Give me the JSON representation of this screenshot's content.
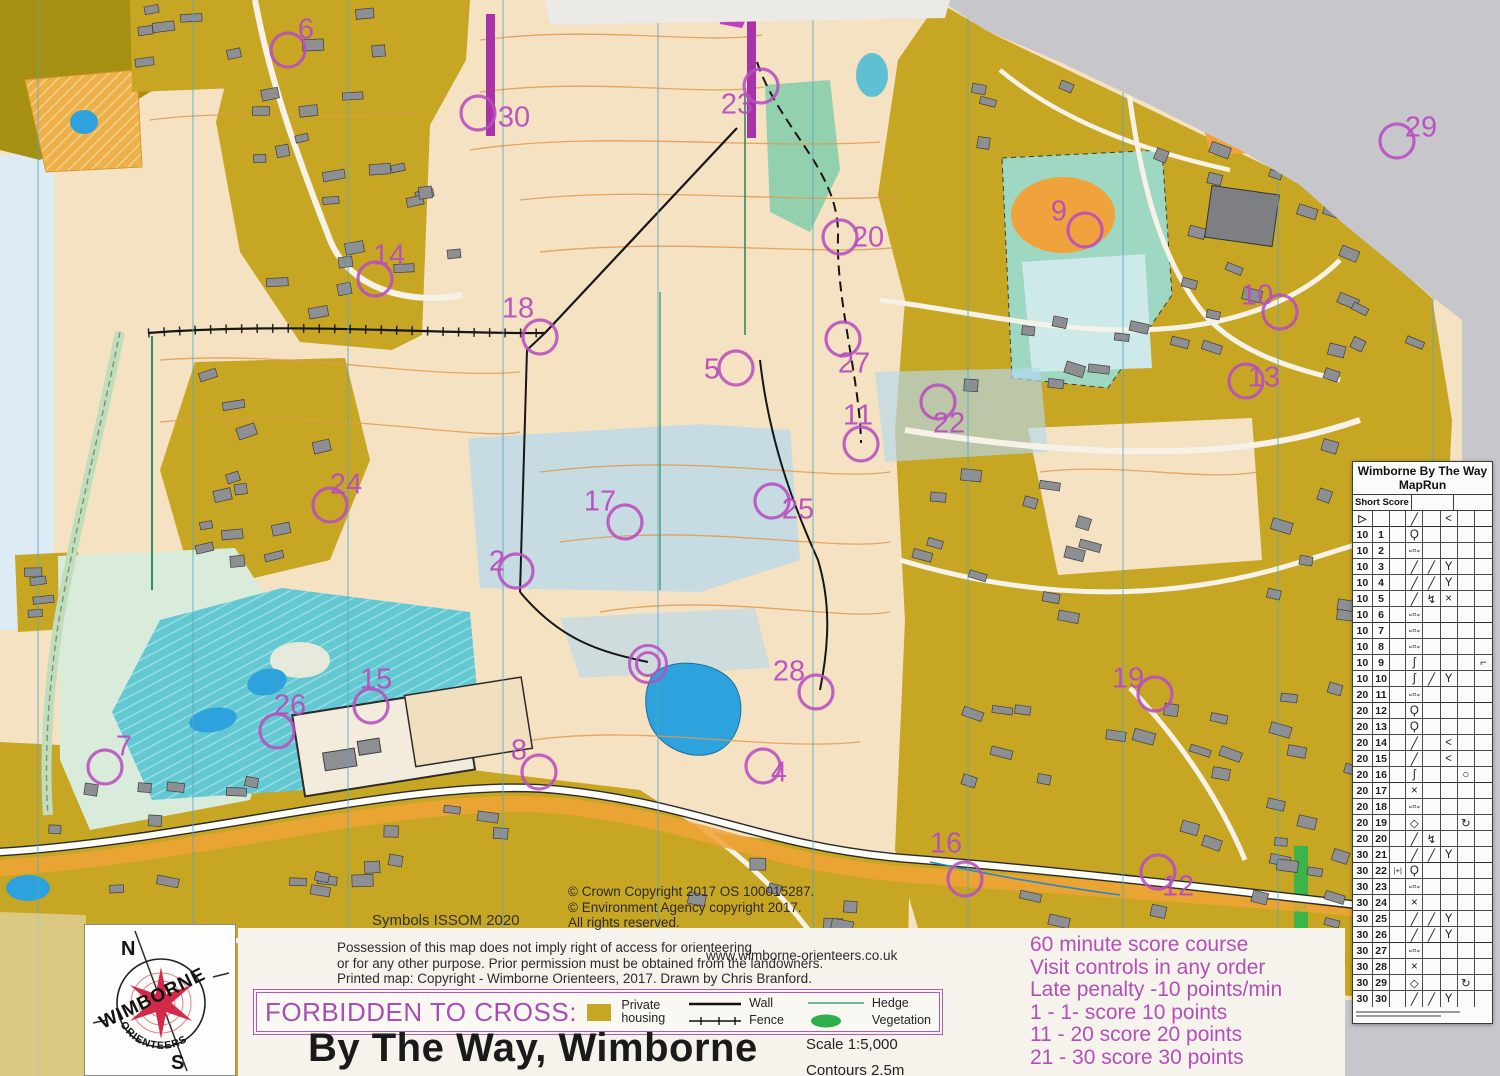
{
  "map_title": "By The Way, Wimborne",
  "forbidden_label": "FORBIDDEN TO CROSS:",
  "scale_label": "Scale 1:5,000",
  "contours_label": "Contours 2.5m",
  "symbols_note": "Symbols ISSOM 2020",
  "website": "www.wimborne-orienteers.co.uk",
  "copyright": {
    "lines": [
      "© Crown Copyright 2017 OS 100015287.",
      "© Environment Agency copyright 2017.",
      "All rights reserved."
    ]
  },
  "disclaimer": {
    "lines": [
      "Possession of this map does not imply right of access for orienteering",
      "or for any other purpose.  Prior permission must be obtained from the landowners.",
      "Printed map: Copyright - Wimborne Orienteers, 2017. Drawn by Chris Branford."
    ]
  },
  "score_rules": {
    "lines": [
      "60 minute score course",
      "Visit controls in any order",
      "Late penalty -10 points/min",
      "1 - 1- score 10 points",
      "11 - 20 score 20 points",
      "21 - 30 score 30 points"
    ]
  },
  "legend": {
    "private_line1": "Private",
    "private_line2": "housing",
    "wall": "Wall",
    "fence": "Fence",
    "hedge": "Hedge",
    "vegetation": "Vegetation"
  },
  "logo": {
    "word_main": "WIMBORNE",
    "word_sub": "ORIENTEERS",
    "north": "N",
    "south": "S"
  },
  "colors": {
    "course": "#b84fbe",
    "housing": "#c7a623",
    "open": "#f4e2c2",
    "water": "#2da2dc",
    "lake": "#63c8d2",
    "paper": "#c7c7cb"
  },
  "control_sheet": {
    "title_line1": "Wimborne By The Way",
    "title_line2": "MapRun",
    "subheader": "Short Score",
    "rows": [
      {
        "a": "▷",
        "b": "",
        "c": "",
        "d": "╱",
        "e": "",
        "f": "<",
        "g": "",
        "h": ""
      },
      {
        "a": "10",
        "b": "1",
        "c": "",
        "d": "Ϙ",
        "e": "",
        "f": "",
        "g": "",
        "h": ""
      },
      {
        "a": "10",
        "b": "2",
        "c": "",
        "d": "-▫-",
        "e": "",
        "f": "",
        "g": "",
        "h": ""
      },
      {
        "a": "10",
        "b": "3",
        "c": "",
        "d": "╱",
        "e": "╱",
        "f": "Y",
        "g": "",
        "h": ""
      },
      {
        "a": "10",
        "b": "4",
        "c": "",
        "d": "╱",
        "e": "╱",
        "f": "Y",
        "g": "",
        "h": ""
      },
      {
        "a": "10",
        "b": "5",
        "c": "",
        "d": "╱",
        "e": "↯",
        "f": "×",
        "g": "",
        "h": ""
      },
      {
        "a": "10",
        "b": "6",
        "c": "",
        "d": "-▫-",
        "e": "",
        "f": "",
        "g": "",
        "h": ""
      },
      {
        "a": "10",
        "b": "7",
        "c": "",
        "d": "-▫-",
        "e": "",
        "f": "",
        "g": "",
        "h": ""
      },
      {
        "a": "10",
        "b": "8",
        "c": "",
        "d": "-▫-",
        "e": "",
        "f": "",
        "g": "",
        "h": ""
      },
      {
        "a": "10",
        "b": "9",
        "c": "",
        "d": "ʃ",
        "e": "",
        "f": "",
        "g": "",
        "h": "⌐"
      },
      {
        "a": "10",
        "b": "10",
        "c": "",
        "d": "ʃ",
        "e": "╱",
        "f": "Y",
        "g": "",
        "h": ""
      },
      {
        "a": "20",
        "b": "11",
        "c": "",
        "d": "-▫-",
        "e": "",
        "f": "",
        "g": "",
        "h": ""
      },
      {
        "a": "20",
        "b": "12",
        "c": "",
        "d": "Ϙ",
        "e": "",
        "f": "",
        "g": "",
        "h": ""
      },
      {
        "a": "20",
        "b": "13",
        "c": "",
        "d": "Ϙ",
        "e": "",
        "f": "",
        "g": "",
        "h": ""
      },
      {
        "a": "20",
        "b": "14",
        "c": "",
        "d": "╱",
        "e": "",
        "f": "<",
        "g": "",
        "h": ""
      },
      {
        "a": "20",
        "b": "15",
        "c": "",
        "d": "╱",
        "e": "",
        "f": "<",
        "g": "",
        "h": ""
      },
      {
        "a": "20",
        "b": "16",
        "c": "",
        "d": "ʃ",
        "e": "",
        "f": "",
        "g": "○",
        "h": ""
      },
      {
        "a": "20",
        "b": "17",
        "c": "",
        "d": "×",
        "e": "",
        "f": "",
        "g": "",
        "h": ""
      },
      {
        "a": "20",
        "b": "18",
        "c": "",
        "d": "-▫-",
        "e": "",
        "f": "",
        "g": "",
        "h": ""
      },
      {
        "a": "20",
        "b": "19",
        "c": "",
        "d": "◇",
        "e": "",
        "f": "",
        "g": "↻",
        "h": ""
      },
      {
        "a": "20",
        "b": "20",
        "c": "",
        "d": "╱",
        "e": "↯",
        "f": "",
        "g": "",
        "h": ""
      },
      {
        "a": "30",
        "b": "21",
        "c": "",
        "d": "╱",
        "e": "╱",
        "f": "Y",
        "g": "",
        "h": ""
      },
      {
        "a": "30",
        "b": "22",
        "c": "|+|",
        "d": "Ϙ",
        "e": "",
        "f": "",
        "g": "",
        "h": ""
      },
      {
        "a": "30",
        "b": "23",
        "c": "",
        "d": "-▫-",
        "e": "",
        "f": "",
        "g": "",
        "h": ""
      },
      {
        "a": "30",
        "b": "24",
        "c": "",
        "d": "×",
        "e": "",
        "f": "",
        "g": "",
        "h": ""
      },
      {
        "a": "30",
        "b": "25",
        "c": "",
        "d": "╱",
        "e": "╱",
        "f": "Y",
        "g": "",
        "h": ""
      },
      {
        "a": "30",
        "b": "26",
        "c": "",
        "d": "╱",
        "e": "╱",
        "f": "Y",
        "g": "",
        "h": ""
      },
      {
        "a": "30",
        "b": "27",
        "c": "",
        "d": "-▫-",
        "e": "",
        "f": "",
        "g": "",
        "h": ""
      },
      {
        "a": "30",
        "b": "28",
        "c": "",
        "d": "×",
        "e": "",
        "f": "",
        "g": "",
        "h": ""
      },
      {
        "a": "30",
        "b": "29",
        "c": "",
        "d": "◇",
        "e": "",
        "f": "",
        "g": "↻",
        "h": ""
      },
      {
        "a": "30",
        "b": "30",
        "c": "",
        "d": "╱",
        "e": "╱",
        "f": "Y",
        "g": "",
        "h": ""
      }
    ]
  },
  "course": {
    "start_finish": {
      "cx": 648,
      "cy": 664
    },
    "controls": [
      {
        "n": "6",
        "lx": 306,
        "ly": 31,
        "cx": 288,
        "cy": 50
      },
      {
        "n": "30",
        "lx": 514,
        "ly": 119,
        "cx": 478,
        "cy": 113
      },
      {
        "n": "23",
        "lx": 737,
        "ly": 106,
        "cx": 761,
        "cy": 86
      },
      {
        "n": "20",
        "lx": 868,
        "ly": 239,
        "cx": 840,
        "cy": 237
      },
      {
        "n": "14",
        "lx": 389,
        "ly": 257,
        "cx": 375,
        "cy": 279
      },
      {
        "n": "18",
        "lx": 518,
        "ly": 310,
        "cx": 540,
        "cy": 337
      },
      {
        "n": "5",
        "lx": 712,
        "ly": 371,
        "cx": 736,
        "cy": 368
      },
      {
        "n": "27",
        "lx": 854,
        "ly": 365,
        "cx": 843,
        "cy": 339
      },
      {
        "n": "29",
        "lx": 1421,
        "ly": 129,
        "cx": 1397,
        "cy": 141
      },
      {
        "n": "9",
        "lx": 1059,
        "ly": 213,
        "cx": 1085,
        "cy": 230
      },
      {
        "n": "10",
        "lx": 1257,
        "ly": 297,
        "cx": 1280,
        "cy": 312
      },
      {
        "n": "13",
        "lx": 1264,
        "ly": 379,
        "cx": 1246,
        "cy": 381
      },
      {
        "n": "11",
        "lx": 858,
        "ly": 417,
        "cx": 861,
        "cy": 444
      },
      {
        "n": "22",
        "lx": 949,
        "ly": 425,
        "cx": 938,
        "cy": 402
      },
      {
        "n": "24",
        "lx": 346,
        "ly": 486,
        "cx": 330,
        "cy": 505
      },
      {
        "n": "17",
        "lx": 600,
        "ly": 503,
        "cx": 625,
        "cy": 522
      },
      {
        "n": "25",
        "lx": 798,
        "ly": 511,
        "cx": 772,
        "cy": 501
      },
      {
        "n": "2",
        "lx": 497,
        "ly": 563,
        "cx": 516,
        "cy": 571
      },
      {
        "n": "15",
        "lx": 376,
        "ly": 681,
        "cx": 371,
        "cy": 706
      },
      {
        "n": "26",
        "lx": 290,
        "ly": 707,
        "cx": 277,
        "cy": 731
      },
      {
        "n": "28",
        "lx": 789,
        "ly": 673,
        "cx": 816,
        "cy": 692
      },
      {
        "n": "19",
        "lx": 1128,
        "ly": 680,
        "cx": 1155,
        "cy": 694
      },
      {
        "n": "7",
        "lx": 124,
        "ly": 748,
        "cx": 105,
        "cy": 767
      },
      {
        "n": "8",
        "lx": 519,
        "ly": 752,
        "cx": 539,
        "cy": 772
      },
      {
        "n": "4",
        "lx": 779,
        "ly": 774,
        "cx": 763,
        "cy": 766
      },
      {
        "n": "16",
        "lx": 946,
        "ly": 845,
        "cx": 965,
        "cy": 879
      },
      {
        "n": "12",
        "lx": 1178,
        "ly": 888,
        "cx": 1158,
        "cy": 872
      }
    ]
  }
}
